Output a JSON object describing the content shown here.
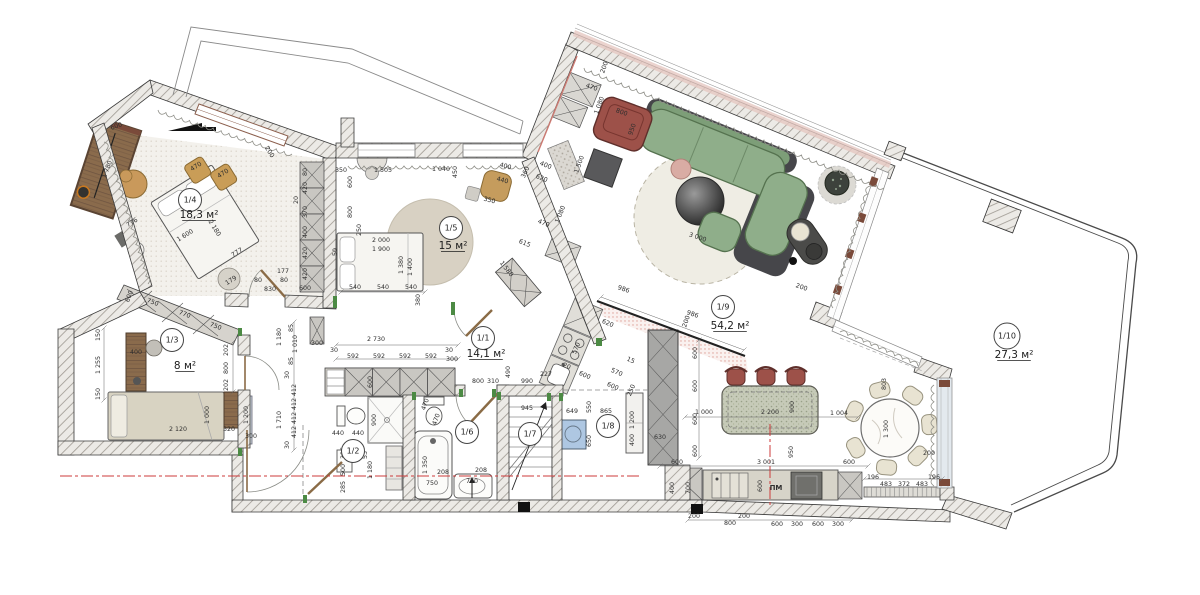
{
  "drawing": {
    "type": "apartment-floor-plan",
    "area_unit": "м²",
    "dishwasher_label": "ПМ"
  },
  "colors": {
    "wall_hatch": "#a29d96",
    "sofa_green": "#8fae8a",
    "armchair_maroon": "#9d5149",
    "wood_brown": "#8a6c4e",
    "section_red": "#cc3b3b",
    "threshold_green": "#4c8a44",
    "appliance_blue": "#aec7e2",
    "rug_beige": "#d8d1c3",
    "island_speckle": "#c6cab8"
  },
  "rooms": [
    {
      "id": "1/1",
      "area": "14,1 м²",
      "cx": 483,
      "cy": 338,
      "ax": 486,
      "ay": 357
    },
    {
      "id": "1/2",
      "area": "",
      "cx": 353,
      "cy": 451,
      "ax": 0,
      "ay": 0
    },
    {
      "id": "1/3",
      "area": "8 м²",
      "cx": 172,
      "cy": 340,
      "ax": 185,
      "ay": 369
    },
    {
      "id": "1/4",
      "area": "18,3 м²",
      "cx": 190,
      "cy": 200,
      "ax": 199,
      "ay": 218
    },
    {
      "id": "1/5",
      "area": "15 м²",
      "cx": 451,
      "cy": 228,
      "ax": 453,
      "ay": 249
    },
    {
      "id": "1/6",
      "area": "",
      "cx": 467,
      "cy": 432,
      "ax": 0,
      "ay": 0
    },
    {
      "id": "1/7",
      "area": "",
      "cx": 530,
      "cy": 434,
      "ax": 0,
      "ay": 0
    },
    {
      "id": "1/8",
      "area": "",
      "cx": 608,
      "cy": 426,
      "ax": 0,
      "ay": 0
    },
    {
      "id": "1/9",
      "area": "54,2 м²",
      "cx": 723,
      "cy": 307,
      "ax": 730,
      "ay": 329
    },
    {
      "id": "1/10",
      "area": "27,3 м²",
      "cx": 1007,
      "cy": 336,
      "ax": 1014,
      "ay": 358
    }
  ],
  "dimensions": [
    {
      "t": "600",
      "x": 117,
      "y": 128,
      "r": -20
    },
    {
      "t": "1 780",
      "x": 109,
      "y": 170,
      "r": -70
    },
    {
      "t": "470",
      "x": 197,
      "y": 168,
      "r": -32
    },
    {
      "t": "470",
      "x": 224,
      "y": 175,
      "r": -32
    },
    {
      "t": "776",
      "x": 133,
      "y": 224,
      "r": -32
    },
    {
      "t": "1 600",
      "x": 186,
      "y": 237,
      "r": -32
    },
    {
      "t": "2 180",
      "x": 213,
      "y": 229,
      "r": 58
    },
    {
      "t": "777",
      "x": 238,
      "y": 254,
      "r": -32
    },
    {
      "t": "179",
      "x": 232,
      "y": 282,
      "r": -32
    },
    {
      "t": "200",
      "x": 268,
      "y": 153,
      "r": 58
    },
    {
      "t": "600",
      "x": 131,
      "y": 297,
      "r": -69
    },
    {
      "t": "750",
      "x": 152,
      "y": 304,
      "r": 21
    },
    {
      "t": "770",
      "x": 184,
      "y": 316,
      "r": 21
    },
    {
      "t": "750",
      "x": 215,
      "y": 328,
      "r": 21
    },
    {
      "t": "150",
      "x": 100,
      "y": 335,
      "r": -90
    },
    {
      "t": "1 255",
      "x": 100,
      "y": 365,
      "r": -90
    },
    {
      "t": "150",
      "x": 100,
      "y": 394,
      "r": -90
    },
    {
      "t": "177",
      "x": 283,
      "y": 273,
      "r": 0
    },
    {
      "t": "80",
      "x": 258,
      "y": 282,
      "r": 0
    },
    {
      "t": "80",
      "x": 284,
      "y": 282,
      "r": 0
    },
    {
      "t": "830",
      "x": 270,
      "y": 291,
      "r": 0
    },
    {
      "t": "600",
      "x": 305,
      "y": 290,
      "r": 0
    },
    {
      "t": "80",
      "x": 307,
      "y": 172,
      "r": -90
    },
    {
      "t": "420",
      "x": 307,
      "y": 188,
      "r": -90
    },
    {
      "t": "370",
      "x": 307,
      "y": 212,
      "r": -90
    },
    {
      "t": "400",
      "x": 307,
      "y": 232,
      "r": -90
    },
    {
      "t": "420",
      "x": 307,
      "y": 253,
      "r": -90
    },
    {
      "t": "420",
      "x": 307,
      "y": 274,
      "r": -90
    },
    {
      "t": "20",
      "x": 298,
      "y": 200,
      "r": -90
    },
    {
      "t": "1 505",
      "x": 383,
      "y": 172,
      "r": 0
    },
    {
      "t": "1 040",
      "x": 441,
      "y": 171,
      "r": 0
    },
    {
      "t": "450",
      "x": 457,
      "y": 172,
      "r": -90
    },
    {
      "t": "350",
      "x": 341,
      "y": 172,
      "r": 0
    },
    {
      "t": "600",
      "x": 352,
      "y": 182,
      "r": -90
    },
    {
      "t": "800",
      "x": 352,
      "y": 212,
      "r": -90
    },
    {
      "t": "250",
      "x": 361,
      "y": 230,
      "r": -90
    },
    {
      "t": "400",
      "x": 505,
      "y": 168,
      "r": 15
    },
    {
      "t": "440",
      "x": 502,
      "y": 182,
      "r": 15
    },
    {
      "t": "350",
      "x": 489,
      "y": 202,
      "r": 15
    },
    {
      "t": "360",
      "x": 527,
      "y": 173,
      "r": -65
    },
    {
      "t": "400",
      "x": 545,
      "y": 167,
      "r": 22
    },
    {
      "t": "620",
      "x": 541,
      "y": 180,
      "r": 22
    },
    {
      "t": "470",
      "x": 543,
      "y": 225,
      "r": 22
    },
    {
      "t": "1 080",
      "x": 562,
      "y": 215,
      "r": -68
    },
    {
      "t": "615",
      "x": 524,
      "y": 245,
      "r": 22
    },
    {
      "t": "1 580",
      "x": 505,
      "y": 270,
      "r": 52
    },
    {
      "t": "2 000",
      "x": 381,
      "y": 242,
      "r": 0
    },
    {
      "t": "1 900",
      "x": 381,
      "y": 251,
      "r": 0
    },
    {
      "t": "50",
      "x": 337,
      "y": 252,
      "r": -90
    },
    {
      "t": "1 380",
      "x": 403,
      "y": 265,
      "r": -90
    },
    {
      "t": "1 400",
      "x": 412,
      "y": 267,
      "r": -90
    },
    {
      "t": "540",
      "x": 355,
      "y": 289,
      "r": 0
    },
    {
      "t": "540",
      "x": 383,
      "y": 289,
      "r": 0
    },
    {
      "t": "540",
      "x": 411,
      "y": 289,
      "r": 0
    },
    {
      "t": "380",
      "x": 420,
      "y": 300,
      "r": -90
    },
    {
      "t": "490",
      "x": 510,
      "y": 372,
      "r": -90
    },
    {
      "t": "2 730",
      "x": 376,
      "y": 341,
      "r": 0
    },
    {
      "t": "30",
      "x": 334,
      "y": 352,
      "r": 0
    },
    {
      "t": "592",
      "x": 353,
      "y": 358,
      "r": 0
    },
    {
      "t": "592",
      "x": 379,
      "y": 358,
      "r": 0
    },
    {
      "t": "592",
      "x": 405,
      "y": 358,
      "r": 0
    },
    {
      "t": "592",
      "x": 431,
      "y": 358,
      "r": 0
    },
    {
      "t": "30",
      "x": 449,
      "y": 352,
      "r": 0
    },
    {
      "t": "300",
      "x": 317,
      "y": 345,
      "r": 0
    },
    {
      "t": "300",
      "x": 452,
      "y": 361,
      "r": 0
    },
    {
      "t": "600",
      "x": 372,
      "y": 382,
      "r": -90
    },
    {
      "t": "85",
      "x": 293,
      "y": 328,
      "r": -90
    },
    {
      "t": "1 010",
      "x": 297,
      "y": 344,
      "r": -90
    },
    {
      "t": "85",
      "x": 293,
      "y": 361,
      "r": -90
    },
    {
      "t": "30",
      "x": 289,
      "y": 375,
      "r": -90
    },
    {
      "t": "412",
      "x": 296,
      "y": 390,
      "r": -90
    },
    {
      "t": "412",
      "x": 296,
      "y": 404,
      "r": -90
    },
    {
      "t": "412",
      "x": 296,
      "y": 418,
      "r": -90
    },
    {
      "t": "412",
      "x": 296,
      "y": 432,
      "r": -90
    },
    {
      "t": "30",
      "x": 289,
      "y": 445,
      "r": -90
    },
    {
      "t": "1 180",
      "x": 281,
      "y": 337,
      "r": -90
    },
    {
      "t": "1 710",
      "x": 281,
      "y": 420,
      "r": -90
    },
    {
      "t": "800",
      "x": 478,
      "y": 383,
      "r": 0
    },
    {
      "t": "310",
      "x": 493,
      "y": 383,
      "r": 0
    },
    {
      "t": "990",
      "x": 527,
      "y": 383,
      "r": 0
    },
    {
      "t": "227",
      "x": 546,
      "y": 376,
      "r": 0
    },
    {
      "t": "986",
      "x": 623,
      "y": 291,
      "r": 19
    },
    {
      "t": "986",
      "x": 692,
      "y": 316,
      "r": 19
    },
    {
      "t": "200",
      "x": 688,
      "y": 322,
      "r": -71
    },
    {
      "t": "200",
      "x": 801,
      "y": 289,
      "r": 19
    },
    {
      "t": "440",
      "x": 338,
      "y": 435,
      "r": 0
    },
    {
      "t": "440",
      "x": 358,
      "y": 435,
      "r": 0
    },
    {
      "t": "900",
      "x": 376,
      "y": 420,
      "r": -90
    },
    {
      "t": "53",
      "x": 367,
      "y": 455,
      "r": -90
    },
    {
      "t": "396",
      "x": 345,
      "y": 453,
      "r": -90
    },
    {
      "t": "500",
      "x": 345,
      "y": 470,
      "r": -90
    },
    {
      "t": "285",
      "x": 345,
      "y": 487,
      "r": -90
    },
    {
      "t": "1 180",
      "x": 372,
      "y": 470,
      "r": -90
    },
    {
      "t": "470",
      "x": 427,
      "y": 405,
      "r": -70
    },
    {
      "t": "470",
      "x": 438,
      "y": 420,
      "r": -70
    },
    {
      "t": "1 350",
      "x": 427,
      "y": 465,
      "r": -90
    },
    {
      "t": "750",
      "x": 432,
      "y": 485,
      "r": 0
    },
    {
      "t": "208",
      "x": 443,
      "y": 474,
      "r": 0
    },
    {
      "t": "710",
      "x": 472,
      "y": 483,
      "r": 0
    },
    {
      "t": "208",
      "x": 481,
      "y": 472,
      "r": 0
    },
    {
      "t": "945",
      "x": 527,
      "y": 410,
      "r": 0
    },
    {
      "t": "649",
      "x": 572,
      "y": 413,
      "r": 0
    },
    {
      "t": "550",
      "x": 591,
      "y": 407,
      "r": -90
    },
    {
      "t": "650",
      "x": 591,
      "y": 441,
      "r": -90
    },
    {
      "t": "865",
      "x": 606,
      "y": 413,
      "r": 0
    },
    {
      "t": "1 200",
      "x": 634,
      "y": 420,
      "r": -90
    },
    {
      "t": "400",
      "x": 634,
      "y": 440,
      "r": -90
    },
    {
      "t": "630",
      "x": 660,
      "y": 439,
      "r": 0
    },
    {
      "t": "620",
      "x": 607,
      "y": 325,
      "r": 23
    },
    {
      "t": "570",
      "x": 578,
      "y": 349,
      "r": -67
    },
    {
      "t": "600",
      "x": 584,
      "y": 377,
      "r": 23
    },
    {
      "t": "570",
      "x": 616,
      "y": 374,
      "r": 23
    },
    {
      "t": "600",
      "x": 612,
      "y": 388,
      "r": 23
    },
    {
      "t": "15",
      "x": 630,
      "y": 362,
      "r": 23
    },
    {
      "t": "20",
      "x": 566,
      "y": 368,
      "r": 23
    },
    {
      "t": "250",
      "x": 633,
      "y": 391,
      "r": -67
    },
    {
      "t": "600",
      "x": 697,
      "y": 353,
      "r": -90
    },
    {
      "t": "600",
      "x": 697,
      "y": 386,
      "r": -90
    },
    {
      "t": "600",
      "x": 697,
      "y": 419,
      "r": -90
    },
    {
      "t": "600",
      "x": 697,
      "y": 451,
      "r": -90
    },
    {
      "t": "1 000",
      "x": 704,
      "y": 414,
      "r": 0
    },
    {
      "t": "2 200",
      "x": 770,
      "y": 414,
      "r": 0
    },
    {
      "t": "900",
      "x": 794,
      "y": 407,
      "r": -90
    },
    {
      "t": "1 004",
      "x": 839,
      "y": 415,
      "r": 0
    },
    {
      "t": "803",
      "x": 886,
      "y": 384,
      "r": -90
    },
    {
      "t": "1 300",
      "x": 888,
      "y": 429,
      "r": -90
    },
    {
      "t": "200",
      "x": 929,
      "y": 455,
      "r": 0
    },
    {
      "t": "950",
      "x": 793,
      "y": 452,
      "r": -90
    },
    {
      "t": "3 001",
      "x": 766,
      "y": 464,
      "r": 0
    },
    {
      "t": "600",
      "x": 677,
      "y": 464,
      "r": 0
    },
    {
      "t": "600",
      "x": 849,
      "y": 464,
      "r": 0
    },
    {
      "t": "600",
      "x": 762,
      "y": 486,
      "r": -90
    },
    {
      "t": "ПМ",
      "x": 776,
      "y": 490,
      "r": 0
    },
    {
      "t": "196",
      "x": 873,
      "y": 479,
      "r": 0
    },
    {
      "t": "483",
      "x": 886,
      "y": 486,
      "r": 0
    },
    {
      "t": "372",
      "x": 904,
      "y": 486,
      "r": 0
    },
    {
      "t": "483",
      "x": 922,
      "y": 486,
      "r": 0
    },
    {
      "t": "196",
      "x": 934,
      "y": 479,
      "r": 0
    },
    {
      "t": "700",
      "x": 690,
      "y": 488,
      "r": -90
    },
    {
      "t": "400",
      "x": 674,
      "y": 488,
      "r": -90
    },
    {
      "t": "200",
      "x": 694,
      "y": 518,
      "r": 0
    },
    {
      "t": "800",
      "x": 730,
      "y": 525,
      "r": 0
    },
    {
      "t": "200",
      "x": 744,
      "y": 518,
      "r": 0
    },
    {
      "t": "600",
      "x": 777,
      "y": 526,
      "r": 0
    },
    {
      "t": "300",
      "x": 797,
      "y": 526,
      "r": 0
    },
    {
      "t": "600",
      "x": 818,
      "y": 526,
      "r": 0
    },
    {
      "t": "300",
      "x": 838,
      "y": 526,
      "r": 0
    },
    {
      "t": "2 120",
      "x": 178,
      "y": 431,
      "r": 0
    },
    {
      "t": "1 000",
      "x": 209,
      "y": 415,
      "r": -90
    },
    {
      "t": "320",
      "x": 229,
      "y": 431,
      "r": 0
    },
    {
      "t": "1 200",
      "x": 248,
      "y": 415,
      "r": -90
    },
    {
      "t": "300",
      "x": 251,
      "y": 438,
      "r": 0
    },
    {
      "t": "202",
      "x": 228,
      "y": 350,
      "r": -90
    },
    {
      "t": "800",
      "x": 228,
      "y": 368,
      "r": -90
    },
    {
      "t": "202",
      "x": 228,
      "y": 385,
      "r": -90
    },
    {
      "t": "400",
      "x": 136,
      "y": 354,
      "r": 0
    },
    {
      "t": "3 000",
      "x": 697,
      "y": 239,
      "r": 19
    },
    {
      "t": "800",
      "x": 621,
      "y": 114,
      "r": 20
    },
    {
      "t": "950",
      "x": 634,
      "y": 130,
      "r": -70
    },
    {
      "t": "1 500",
      "x": 581,
      "y": 165,
      "r": -70
    },
    {
      "t": "470",
      "x": 591,
      "y": 89,
      "r": 20
    },
    {
      "t": "1 080",
      "x": 601,
      "y": 106,
      "r": -70
    },
    {
      "t": "200",
      "x": 606,
      "y": 68,
      "r": -70
    }
  ]
}
